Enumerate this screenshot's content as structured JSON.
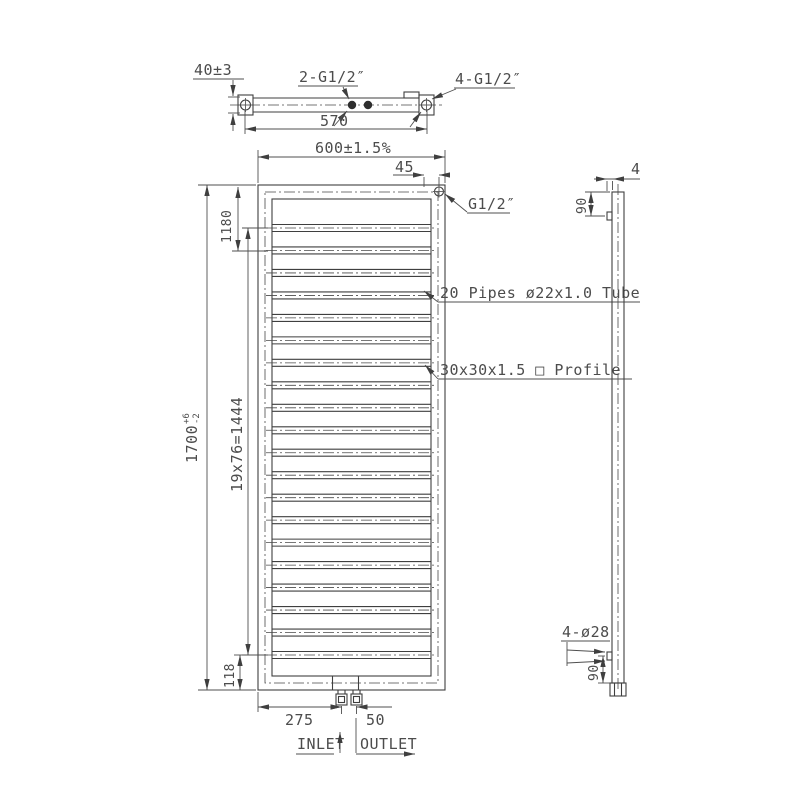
{
  "meta": {
    "background_color": "#ffffff",
    "line_color": "#3f3f3f",
    "text_color": "#4c4c4c",
    "drawing_type": "towel radiator technical drawing, three views"
  },
  "top_view": {
    "dim_bracket_depth": "40±3",
    "label_center_connections": "2-G1/2″",
    "label_corner_connections": "4-G1/2″",
    "dim_bracket_span": "570"
  },
  "front_view": {
    "dim_width": "600±1.5%",
    "dim_connection_offset": "45",
    "label_top_connection": "G1/2″",
    "dim_upper": "1180",
    "dim_height": "1700",
    "dim_height_tol_up": "+6",
    "dim_height_tol_dn": "-2",
    "dim_pipe_pitch": "19x76=1444",
    "dim_bottom_offset": "118",
    "label_pipes": "20 Pipes ø22x1.0 Tube",
    "label_profile": "30x30x1.5 □ Profile",
    "dim_inlet_offset": "275",
    "dim_inlet_outlet_gap": "50",
    "label_inlet": "INLET",
    "label_outlet": "OUTLET",
    "pipe_count": 20
  },
  "side_view": {
    "dim_plate_thickness": "4",
    "dim_top_bracket": "90",
    "dim_bottom_bracket": "90",
    "label_mounting_holes": "4-ø28"
  }
}
